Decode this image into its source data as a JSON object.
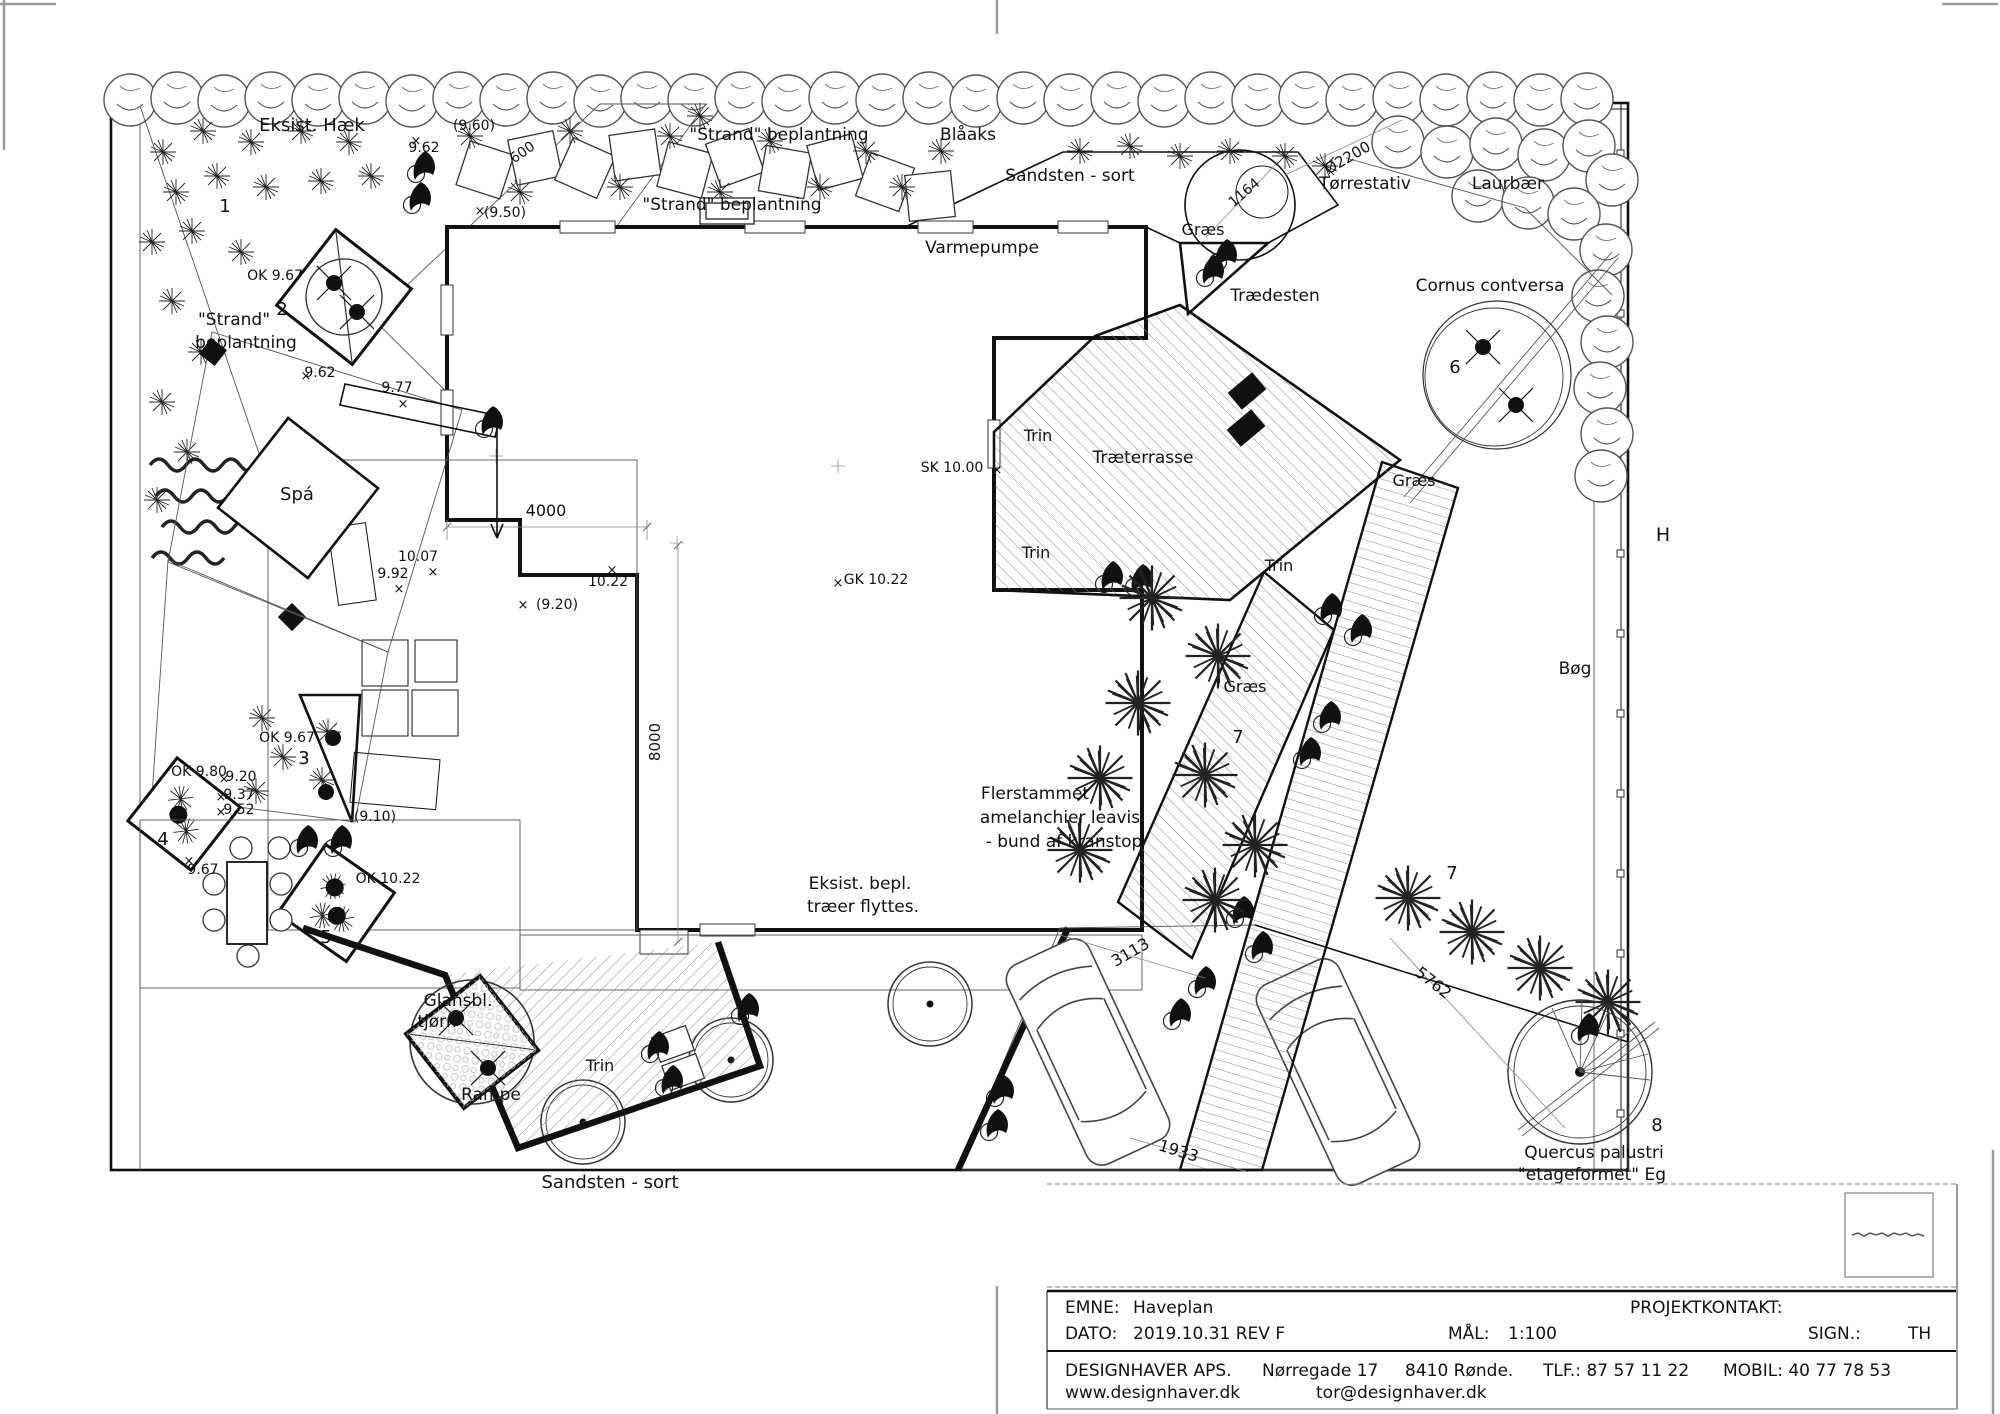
{
  "title_block": {
    "emne_label": "EMNE:",
    "emne": "Haveplan",
    "projektkontakt_label": "PROJEKTKONTAKT:",
    "dato_label": "DATO:",
    "dato": "2019.10.31 REV F",
    "maal_label": "MÅL:",
    "maal": "1:100",
    "sign_label": "SIGN.:",
    "sign": "TH",
    "firm": "DESIGNHAVER APS.",
    "address": "Nørregade 17",
    "city": "8410 Rønde.",
    "tlf": "TLF.: 87 57 11 22",
    "mobil": "MOBIL: 40 77 78 53",
    "web": "www.designhaver.dk",
    "email": "tor@designhaver.dk"
  },
  "plan": {
    "scale": "1:100",
    "labels": [
      {
        "n": "eksist-haek",
        "t": "Eksist. Hæk",
        "x": 312,
        "y": 131,
        "s": 18
      },
      {
        "n": "dim-9-60",
        "t": "(9.60)",
        "x": 474,
        "y": 130,
        "s": 14
      },
      {
        "n": "dim-9-62-top",
        "t": "9.62",
        "x": 424,
        "y": 152,
        "s": 14
      },
      {
        "n": "strand-beplantning-top1",
        "t": "\"Strand\" beplantning",
        "x": 779,
        "y": 140,
        "s": 17
      },
      {
        "n": "blaaks",
        "t": "Blåaks",
        "x": 968,
        "y": 140,
        "s": 17
      },
      {
        "n": "sandsten-sort-top",
        "t": "Sandsten - sort",
        "x": 1070,
        "y": 181,
        "s": 17
      },
      {
        "n": "torrestativ",
        "t": "Tørrestativ",
        "x": 1365,
        "y": 189,
        "s": 17
      },
      {
        "n": "laurbaer",
        "t": "Laurbær",
        "x": 1508,
        "y": 189,
        "s": 17
      },
      {
        "n": "strand-beplantning-top2",
        "t": "\"Strand\" beplantning",
        "x": 732,
        "y": 210,
        "s": 17
      },
      {
        "n": "dim-9-50",
        "t": "(9.50)",
        "x": 505,
        "y": 217,
        "s": 14
      },
      {
        "n": "varmepumpe",
        "t": "Varmepumpe",
        "x": 982,
        "y": 253,
        "s": 17
      },
      {
        "n": "graes-ne",
        "t": "Græs",
        "x": 1203,
        "y": 235,
        "s": 16
      },
      {
        "n": "traedesten",
        "t": "Trædesten",
        "x": 1275,
        "y": 301,
        "s": 17
      },
      {
        "n": "cornus-contversa",
        "t": "Cornus contversa",
        "x": 1490,
        "y": 291,
        "s": 17
      },
      {
        "n": "dim-ok-9-67-sculpture",
        "t": "OK 9.67",
        "x": 275,
        "y": 280,
        "s": 14
      },
      {
        "n": "strand-left-1",
        "t": "\"Strand\"",
        "x": 234,
        "y": 325,
        "s": 17
      },
      {
        "n": "strand-left-2",
        "t": "beplantning",
        "x": 246,
        "y": 348,
        "s": 17
      },
      {
        "n": "dim-9-62-spa",
        "t": "9.62",
        "x": 320,
        "y": 377,
        "s": 14
      },
      {
        "n": "dim-9-77",
        "t": "9.77",
        "x": 397,
        "y": 392,
        "s": 14
      },
      {
        "n": "spa",
        "t": "Spá",
        "x": 297,
        "y": 500,
        "s": 18
      },
      {
        "n": "dim-4000",
        "t": "4000",
        "x": 546,
        "y": 516,
        "s": 16
      },
      {
        "n": "trin-terrasse-top",
        "t": "Trin",
        "x": 1038,
        "y": 441,
        "s": 16
      },
      {
        "n": "traeterrasse",
        "t": "Træterrasse",
        "x": 1143,
        "y": 463,
        "s": 17
      },
      {
        "n": "dim-sk-10-00",
        "t": "SK 10.00",
        "x": 952,
        "y": 472,
        "s": 14
      },
      {
        "n": "trin-terrasse-bottom",
        "t": "Trin",
        "x": 1036,
        "y": 558,
        "s": 16
      },
      {
        "n": "trin-path-east",
        "t": "Trin",
        "x": 1279,
        "y": 571,
        "s": 16
      },
      {
        "n": "dim-gk-10-22",
        "t": "GK 10.22",
        "x": 876,
        "y": 584,
        "s": 14
      },
      {
        "n": "dim-10-22",
        "t": "10.22",
        "x": 608,
        "y": 586,
        "s": 14
      },
      {
        "n": "dim-10-07",
        "t": "10.07",
        "x": 418,
        "y": 561,
        "s": 14
      },
      {
        "n": "dim-9-92",
        "t": "9.92",
        "x": 393,
        "y": 578,
        "s": 14
      },
      {
        "n": "dim-9-20-paren",
        "t": "(9.20)",
        "x": 557,
        "y": 609,
        "s": 14
      },
      {
        "n": "graes-mid",
        "t": "Græs",
        "x": 1245,
        "y": 692,
        "s": 16
      },
      {
        "n": "graes-right",
        "t": "Græs",
        "x": 1414,
        "y": 486,
        "s": 16
      },
      {
        "n": "h-mark",
        "t": "H",
        "x": 1663,
        "y": 541,
        "s": 19
      },
      {
        "n": "boeg",
        "t": "Bøg",
        "x": 1575,
        "y": 674,
        "s": 17
      },
      {
        "n": "dim-ok-9-67-bed",
        "t": "OK 9.67",
        "x": 287,
        "y": 742,
        "s": 14
      },
      {
        "n": "dim-ok-9-80",
        "t": "OK 9.80",
        "x": 199,
        "y": 776,
        "s": 14
      },
      {
        "n": "dim-9-20",
        "t": "9.20",
        "x": 241,
        "y": 781,
        "s": 14
      },
      {
        "n": "dim-9-37",
        "t": "9.37",
        "x": 239,
        "y": 799,
        "s": 14
      },
      {
        "n": "dim-9-52",
        "t": "9.52",
        "x": 239,
        "y": 814,
        "s": 14
      },
      {
        "n": "dim-9-10-paren",
        "t": "(9.10)",
        "x": 375,
        "y": 821,
        "s": 14
      },
      {
        "n": "dim-9-67",
        "t": "9.67",
        "x": 203,
        "y": 874,
        "s": 14
      },
      {
        "n": "dim-ok-10-22",
        "t": "OK 10.22",
        "x": 388,
        "y": 883,
        "s": 14
      },
      {
        "n": "flerstammet-1",
        "t": "Flerstammet",
        "x": 1035,
        "y": 799,
        "s": 17
      },
      {
        "n": "flerstammet-2",
        "t": "amelanchier leavis",
        "x": 1060,
        "y": 823,
        "s": 17
      },
      {
        "n": "flerstammet-3",
        "t": "- bund af kranstop",
        "x": 1064,
        "y": 847,
        "s": 17
      },
      {
        "n": "eksist-bepl-1",
        "t": "Eksist. bepl.",
        "x": 860,
        "y": 889,
        "s": 17
      },
      {
        "n": "eksist-bepl-2",
        "t": "træer flyttes.",
        "x": 863,
        "y": 912,
        "s": 17
      },
      {
        "n": "glansbl-1",
        "t": "Glansbl.",
        "x": 458,
        "y": 1006,
        "s": 17
      },
      {
        "n": "glansbl-2",
        "t": "tjørn",
        "x": 437,
        "y": 1027,
        "s": 17
      },
      {
        "n": "trin-rampe",
        "t": "Trin",
        "x": 600,
        "y": 1071,
        "s": 16
      },
      {
        "n": "rampe",
        "t": "Rampe",
        "x": 491,
        "y": 1100,
        "s": 17
      },
      {
        "n": "sandsten-sort-bottom",
        "t": "Sandsten - sort",
        "x": 610,
        "y": 1188,
        "s": 18
      },
      {
        "n": "quercus-1",
        "t": "Quercus palustri",
        "x": 1594,
        "y": 1158,
        "s": 17
      },
      {
        "n": "quercus-2",
        "t": "\"etageformet\" Eg",
        "x": 1592,
        "y": 1180,
        "s": 17
      },
      {
        "n": "dim-600",
        "t": "600",
        "x": 525,
        "y": 156,
        "s": 14,
        "r": -35
      },
      {
        "n": "dim-1164",
        "t": "1164",
        "x": 1247,
        "y": 196,
        "s": 14,
        "r": -40
      },
      {
        "n": "dim-o2200",
        "t": "Ø2200",
        "x": 1350,
        "y": 162,
        "s": 15,
        "r": -30
      },
      {
        "n": "dim-3113",
        "t": "3113",
        "x": 1133,
        "y": 957,
        "s": 16,
        "r": -30
      },
      {
        "n": "dim-1933",
        "t": "1933",
        "x": 1177,
        "y": 1156,
        "s": 16,
        "r": 17
      },
      {
        "n": "dim-5762",
        "t": "5762",
        "x": 1430,
        "y": 987,
        "s": 16,
        "r": 38
      },
      {
        "n": "dim-8000",
        "t": "8000",
        "x": 660,
        "y": 742,
        "s": 15,
        "r": -90
      },
      {
        "n": "key-1",
        "t": "1",
        "x": 225,
        "y": 212,
        "s": 18
      },
      {
        "n": "key-2",
        "t": "2",
        "x": 282,
        "y": 315,
        "s": 18
      },
      {
        "n": "key-3",
        "t": "3",
        "x": 304,
        "y": 764,
        "s": 18
      },
      {
        "n": "key-4",
        "t": "4",
        "x": 163,
        "y": 845,
        "s": 18
      },
      {
        "n": "key-5",
        "t": "5",
        "x": 326,
        "y": 943,
        "s": 18
      },
      {
        "n": "key-6",
        "t": "6",
        "x": 1455,
        "y": 373,
        "s": 18
      },
      {
        "n": "key-7a",
        "t": "7",
        "x": 1238,
        "y": 743,
        "s": 18
      },
      {
        "n": "key-7b",
        "t": "7",
        "x": 1452,
        "y": 879,
        "s": 18
      },
      {
        "n": "key-8",
        "t": "8",
        "x": 1657,
        "y": 1131,
        "s": 18
      },
      {
        "n": "x-1",
        "t": "×",
        "x": 416,
        "y": 145,
        "s": 13
      },
      {
        "n": "x-2",
        "t": "×",
        "x": 480,
        "y": 215,
        "s": 13
      },
      {
        "n": "x-3",
        "t": "×",
        "x": 306,
        "y": 380,
        "s": 13
      },
      {
        "n": "x-4",
        "t": "×",
        "x": 403,
        "y": 408,
        "s": 13
      },
      {
        "n": "x-5",
        "t": "×",
        "x": 399,
        "y": 593,
        "s": 13
      },
      {
        "n": "x-6",
        "t": "×",
        "x": 523,
        "y": 609,
        "s": 13
      },
      {
        "n": "x-7",
        "t": "×",
        "x": 612,
        "y": 574,
        "s": 13
      },
      {
        "n": "x-8",
        "t": "×",
        "x": 838,
        "y": 587,
        "s": 13
      },
      {
        "n": "x-9",
        "t": "×",
        "x": 997,
        "y": 474,
        "s": 13
      },
      {
        "n": "x-10",
        "t": "×",
        "x": 224,
        "y": 783,
        "s": 13
      },
      {
        "n": "x-11",
        "t": "×",
        "x": 221,
        "y": 801,
        "s": 13
      },
      {
        "n": "x-12",
        "t": "×",
        "x": 221,
        "y": 816,
        "s": 13
      },
      {
        "n": "x-13",
        "t": "×",
        "x": 189,
        "y": 865,
        "s": 13
      },
      {
        "n": "x-14",
        "t": "×",
        "x": 433,
        "y": 576,
        "s": 13
      }
    ]
  }
}
